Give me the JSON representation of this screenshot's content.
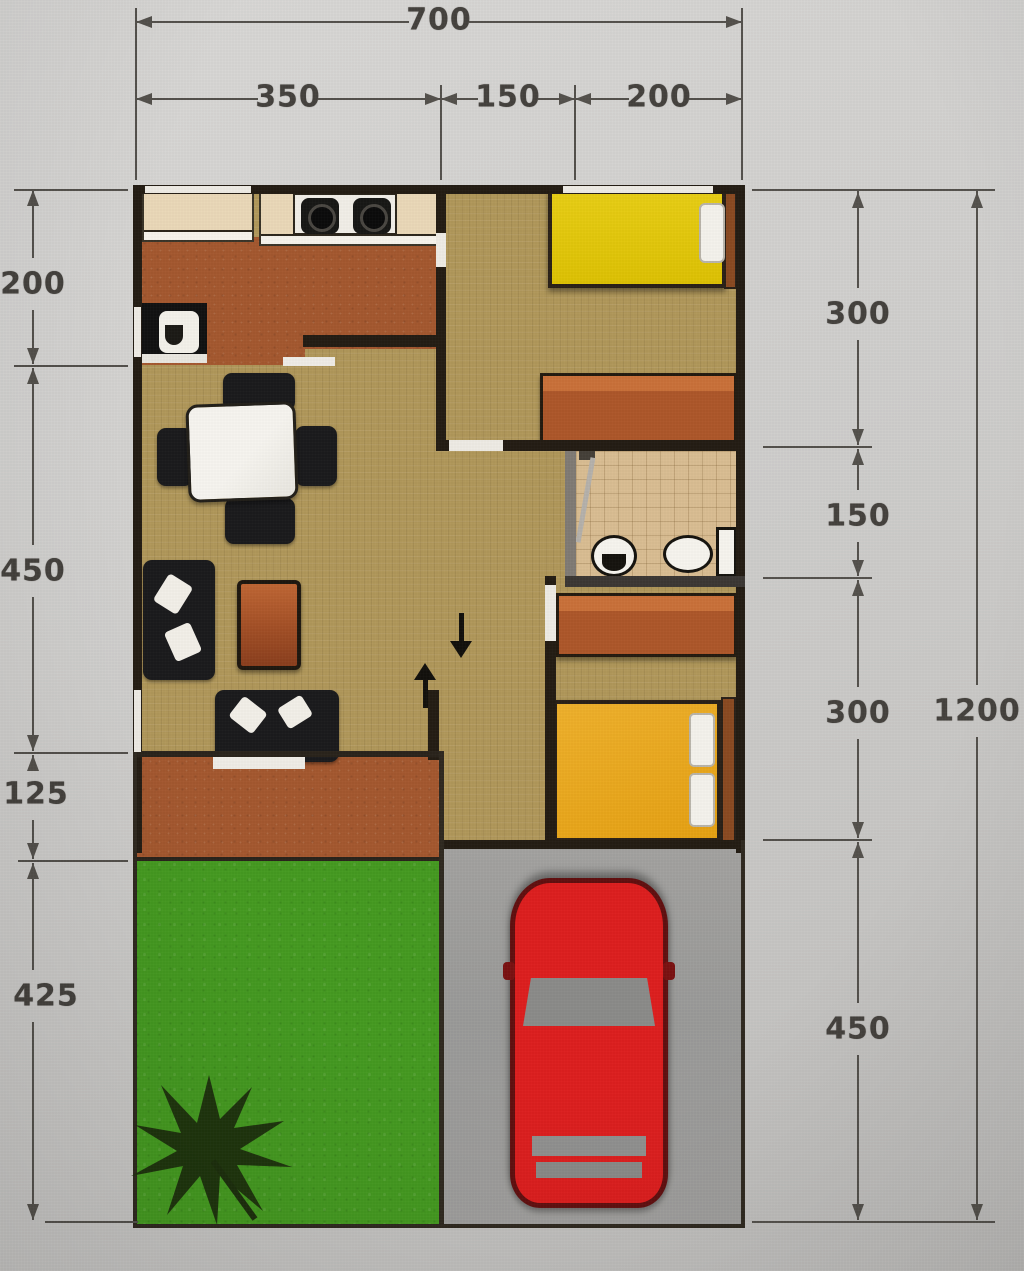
{
  "dimensions": {
    "top": {
      "total": "700",
      "segments": [
        "350",
        "150",
        "200"
      ]
    },
    "left": {
      "segments": [
        "200",
        "450",
        "125",
        "425"
      ]
    },
    "right": {
      "segments": [
        "300",
        "150",
        "300",
        "450"
      ],
      "total": "1200"
    }
  },
  "objects": {
    "kitchen": [
      "counter",
      "stove",
      "sink"
    ],
    "living_dining": [
      "dining-table",
      "chairs",
      "sofa",
      "side-table",
      "bench-sofa",
      "door-mat"
    ],
    "bedroom_top": [
      "single-bed-yellow",
      "pillow",
      "headboard",
      "wardrobe"
    ],
    "bathroom": [
      "shower",
      "washbasin",
      "toilet"
    ],
    "bedroom_bottom": [
      "double-bed-orange",
      "pillows",
      "headboard",
      "wardrobe"
    ],
    "outside": [
      "porch",
      "lawn",
      "tree",
      "driveway",
      "car"
    ]
  },
  "colors": {
    "page_bg": "#d0cfcd",
    "wall": "#241d14",
    "floor_tan": "#b0975a",
    "floor_terracotta": "#a4582f",
    "bathroom_floor": "#d9bd92",
    "counter_beige": "#ead8b8",
    "bed_yellow": "#e0c40a",
    "bed_orange": "#e9a71c",
    "wood_brown": "#ad572a",
    "grass_green": "#459a21",
    "driveway_gray": "#9e9d9b",
    "car_red": "#dd1f1f",
    "dimension_text": "#45423e"
  }
}
